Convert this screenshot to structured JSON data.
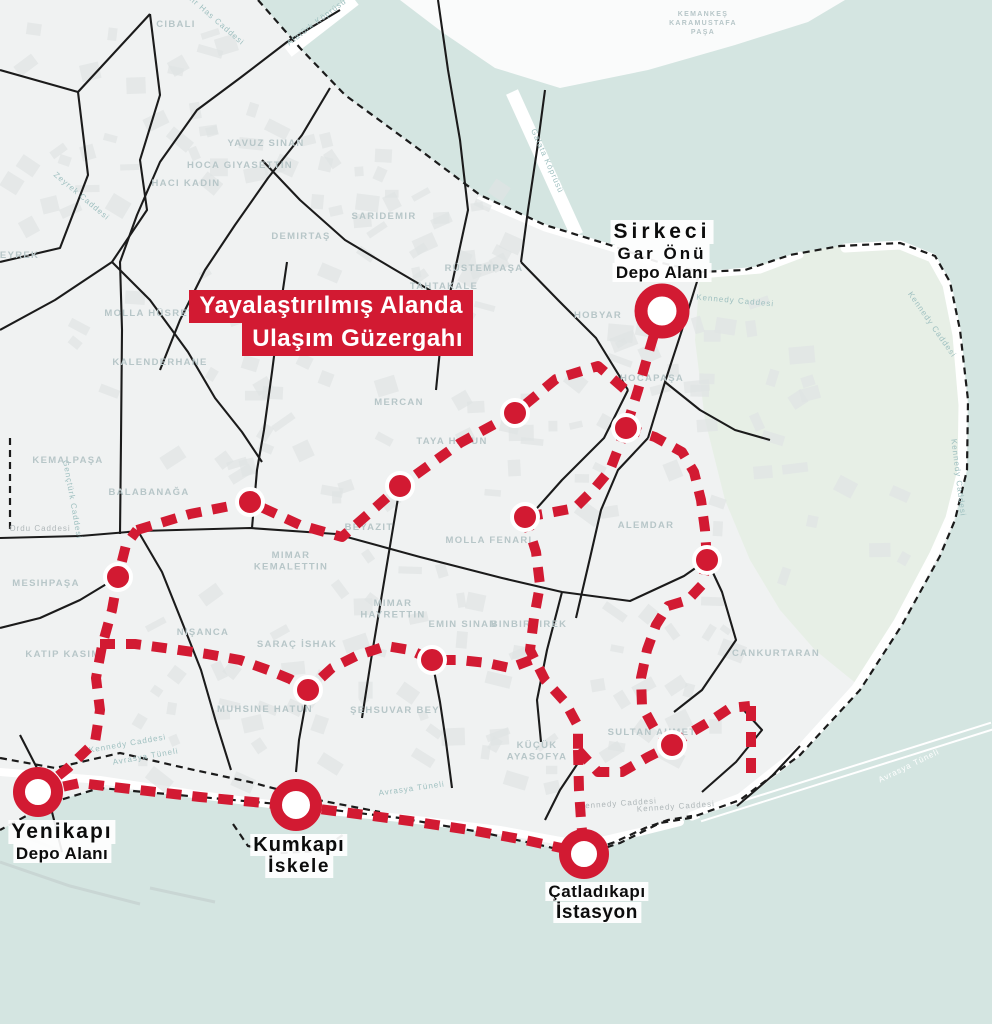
{
  "title": {
    "line1": "Yayalaştırılmış Alanda",
    "line2": "Ulaşım Güzergahı"
  },
  "colors": {
    "water": "#d4e5e1",
    "land": "#f0f2f2",
    "land_far": "#fafbfb",
    "park": "#e7efe6",
    "building": "#dfe4e4",
    "boundary": "#1b1b1b",
    "route_red": "#d21a32",
    "area_label": "#b7c6c8",
    "street_teal": "#9fc0c0",
    "street_gray": "#b0b8ba",
    "pier_gray": "#c9d6d4",
    "road_white": "#ffffff"
  },
  "terminals": [
    {
      "id": "sirkeci",
      "x": 662,
      "y": 311,
      "r": 21,
      "ring": 13,
      "label": [
        "Sirkeci",
        "Gar Önü",
        "Depo Alanı"
      ],
      "label_x": 662,
      "label_y": 220
    },
    {
      "id": "yenikapi",
      "x": 38,
      "y": 792,
      "r": 19,
      "ring": 12,
      "label": [
        "Yenikapı",
        "Depo Alanı"
      ],
      "label_x": 62,
      "label_y": 820
    },
    {
      "id": "kumkapi",
      "x": 296,
      "y": 805,
      "r": 20,
      "ring": 12,
      "label": [
        "Kumkapı",
        "İskele"
      ],
      "label_x": 299,
      "label_y": 834
    },
    {
      "id": "catladikapi",
      "x": 584,
      "y": 854,
      "r": 19,
      "ring": 12,
      "label": [
        "Çatladıkapı",
        "İstasyon"
      ],
      "label_x": 597,
      "label_y": 882
    }
  ],
  "route": {
    "stops": [
      [
        250,
        502
      ],
      [
        118,
        577
      ],
      [
        400,
        486
      ],
      [
        515,
        413
      ],
      [
        626,
        428
      ],
      [
        525,
        517
      ],
      [
        707,
        560
      ],
      [
        308,
        690
      ],
      [
        432,
        660
      ],
      [
        672,
        745
      ]
    ],
    "lines": [
      {
        "name": "coastal",
        "points": [
          [
            38,
            792
          ],
          [
            80,
            783
          ],
          [
            130,
            789
          ],
          [
            200,
            797
          ],
          [
            296,
            806
          ],
          [
            350,
            813
          ],
          [
            410,
            821
          ],
          [
            470,
            830
          ],
          [
            525,
            840
          ],
          [
            584,
            853
          ]
        ]
      },
      {
        "name": "west-vertical",
        "points": [
          [
            38,
            792
          ],
          [
            68,
            768
          ],
          [
            95,
            742
          ],
          [
            100,
            710
          ],
          [
            96,
            678
          ],
          [
            102,
            646
          ],
          [
            112,
            610
          ],
          [
            118,
            577
          ],
          [
            126,
            545
          ],
          [
            137,
            530
          ]
        ]
      },
      {
        "name": "central",
        "points": [
          [
            137,
            530
          ],
          [
            190,
            514
          ],
          [
            250,
            502
          ],
          [
            300,
            525
          ],
          [
            342,
            537
          ],
          [
            400,
            486
          ],
          [
            460,
            443
          ],
          [
            515,
            413
          ],
          [
            556,
            379
          ],
          [
            598,
            366
          ],
          [
            628,
            392
          ]
        ]
      },
      {
        "name": "sirkeci-link",
        "points": [
          [
            661,
            311
          ],
          [
            650,
            348
          ],
          [
            638,
            390
          ],
          [
            626,
            428
          ]
        ]
      },
      {
        "name": "hocapasa-alemdar",
        "points": [
          [
            626,
            428
          ],
          [
            655,
            437
          ],
          [
            682,
            452
          ],
          [
            694,
            472
          ],
          [
            701,
            500
          ],
          [
            705,
            530
          ],
          [
            707,
            560
          ]
        ]
      },
      {
        "name": "hocapasa-mollafenari",
        "points": [
          [
            626,
            428
          ],
          [
            610,
            470
          ],
          [
            595,
            488
          ],
          [
            575,
            508
          ],
          [
            549,
            513
          ],
          [
            525,
            517
          ]
        ]
      },
      {
        "name": "mollafenari-kucukayasofya",
        "points": [
          [
            525,
            517
          ],
          [
            536,
            552
          ],
          [
            540,
            585
          ],
          [
            534,
            618
          ],
          [
            530,
            650
          ],
          [
            545,
            680
          ],
          [
            565,
            702
          ],
          [
            578,
            726
          ],
          [
            578,
            750
          ]
        ]
      },
      {
        "name": "kucukayasofya-sultan",
        "points": [
          [
            578,
            750
          ],
          [
            598,
            772
          ],
          [
            622,
            772
          ],
          [
            648,
            757
          ],
          [
            672,
            745
          ]
        ]
      },
      {
        "name": "kucukayasofya-catladikapi",
        "points": [
          [
            578,
            750
          ],
          [
            579,
            790
          ],
          [
            581,
            820
          ],
          [
            584,
            853
          ]
        ]
      },
      {
        "name": "alemdar-sultan",
        "points": [
          [
            707,
            560
          ],
          [
            702,
            585
          ],
          [
            688,
            600
          ],
          [
            668,
            606
          ],
          [
            656,
            625
          ],
          [
            647,
            650
          ],
          [
            641,
            678
          ],
          [
            642,
            706
          ],
          [
            654,
            728
          ],
          [
            672,
            745
          ]
        ]
      },
      {
        "name": "nisanca",
        "points": [
          [
            100,
            644
          ],
          [
            135,
            644
          ],
          [
            172,
            649
          ],
          [
            207,
            654
          ],
          [
            240,
            660
          ],
          [
            268,
            670
          ],
          [
            290,
            679
          ],
          [
            308,
            690
          ],
          [
            332,
            668
          ],
          [
            356,
            656
          ],
          [
            386,
            646
          ],
          [
            410,
            650
          ],
          [
            432,
            660
          ],
          [
            460,
            660
          ],
          [
            487,
            663
          ],
          [
            510,
            668
          ],
          [
            531,
            660
          ]
        ]
      },
      {
        "name": "east-branch",
        "points": [
          [
            672,
            745
          ],
          [
            690,
            733
          ],
          [
            712,
            720
          ],
          [
            730,
            708
          ],
          [
            750,
            706
          ]
        ]
      },
      {
        "name": "east-branch-vertical",
        "points": [
          [
            751,
            706
          ],
          [
            751,
            740
          ],
          [
            751,
            773
          ]
        ]
      }
    ]
  },
  "area_labels": [
    {
      "text": "CIBALI",
      "x": 176,
      "y": 27
    },
    {
      "text": "KEMANKEŞ\nKARAMUSTAFA\nPAŞA",
      "x": 703,
      "y": 16,
      "fs": 7
    },
    {
      "text": "YAVUZ SINAN",
      "x": 266,
      "y": 146
    },
    {
      "text": "HOCA GIYASETTIN",
      "x": 240,
      "y": 168
    },
    {
      "text": "HACI KADIN",
      "x": 186,
      "y": 186
    },
    {
      "text": "SARIDEMIR",
      "x": 384,
      "y": 219
    },
    {
      "text": "DEMIRTAŞ",
      "x": 301,
      "y": 239
    },
    {
      "text": "RÜSTEMPAŞA",
      "x": 484,
      "y": 271
    },
    {
      "text": "TAHTAKALE",
      "x": 444,
      "y": 289
    },
    {
      "text": "ZEYREK",
      "x": 16,
      "y": 258
    },
    {
      "text": "MOLLA HÜSREV",
      "x": 150,
      "y": 316
    },
    {
      "text": "HOBYAR",
      "x": 598,
      "y": 318
    },
    {
      "text": "KALENDERHANE",
      "x": 160,
      "y": 365
    },
    {
      "text": "MERCAN",
      "x": 399,
      "y": 405
    },
    {
      "text": "TAYA HATUN",
      "x": 452,
      "y": 444
    },
    {
      "text": "HOCAPAŞA",
      "x": 652,
      "y": 381
    },
    {
      "text": "KEMALPAŞA",
      "x": 68,
      "y": 463
    },
    {
      "text": "BALABANAĞA",
      "x": 149,
      "y": 495
    },
    {
      "text": "BEYAZIT",
      "x": 369,
      "y": 530
    },
    {
      "text": "MOLLA FENARI",
      "x": 489,
      "y": 543
    },
    {
      "text": "ALEMDAR",
      "x": 646,
      "y": 528
    },
    {
      "text": "MIMAR\nKEMALETTIN",
      "x": 291,
      "y": 558
    },
    {
      "text": "MESIHPAŞA",
      "x": 46,
      "y": 586
    },
    {
      "text": "MIMAR\nHAYRETTIN",
      "x": 393,
      "y": 606
    },
    {
      "text": "EMIN SINAN",
      "x": 463,
      "y": 627
    },
    {
      "text": "BINBIRDIREK",
      "x": 529,
      "y": 627
    },
    {
      "text": "NIŞANCA",
      "x": 203,
      "y": 635
    },
    {
      "text": "SARAÇ İSHAK",
      "x": 297,
      "y": 647
    },
    {
      "text": "KATIP KASIM",
      "x": 63,
      "y": 657
    },
    {
      "text": "MUHSINE HATUN",
      "x": 265,
      "y": 712
    },
    {
      "text": "ŞEHSUVAR BEY",
      "x": 395,
      "y": 713
    },
    {
      "text": "KÜÇÜK\nAYASOFYA",
      "x": 537,
      "y": 748
    },
    {
      "text": "SULTAN AHMET",
      "x": 652,
      "y": 735
    },
    {
      "text": "CANKURTARAN",
      "x": 776,
      "y": 656
    }
  ],
  "street_labels": [
    {
      "text": "Kadir Has Caddesi",
      "x": 210,
      "y": 18,
      "rot": 41,
      "tone": "teal"
    },
    {
      "text": "Atatürk Köprüsü",
      "x": 318,
      "y": 24,
      "rot": -37,
      "tone": "teal"
    },
    {
      "text": "Galata Köprüsü",
      "x": 545,
      "y": 162,
      "rot": 66,
      "tone": "teal"
    },
    {
      "text": "Zeyrek Caddesi",
      "x": 80,
      "y": 198,
      "rot": 40,
      "tone": "teal"
    },
    {
      "text": "Kennedy Caddesi",
      "x": 735,
      "y": 303,
      "rot": 5,
      "tone": "teal"
    },
    {
      "text": "Kennedy Caddesi",
      "x": 930,
      "y": 326,
      "rot": 55,
      "tone": "teal"
    },
    {
      "text": "Kennedy Caddesi",
      "x": 956,
      "y": 478,
      "rot": 83,
      "tone": "teal"
    },
    {
      "text": "Gençtürk Caddesi",
      "x": 70,
      "y": 500,
      "rot": 80,
      "tone": "teal"
    },
    {
      "text": "Ordu Caddesi",
      "x": 40,
      "y": 531,
      "rot": 0,
      "tone": "gray"
    },
    {
      "text": "Kennedy Caddesi",
      "x": 128,
      "y": 746,
      "rot": -10,
      "tone": "teal"
    },
    {
      "text": "Avrasya Tüneli",
      "x": 146,
      "y": 759,
      "rot": -10,
      "tone": "teal"
    },
    {
      "text": "Avrasya Tüneli",
      "x": 412,
      "y": 791,
      "rot": -8,
      "tone": "teal"
    },
    {
      "text": "Kennedy Caddesi",
      "x": 618,
      "y": 806,
      "rot": -4,
      "tone": "gray"
    },
    {
      "text": "Kennedy Caddesi",
      "x": 676,
      "y": 809,
      "rot": -4,
      "tone": "gray"
    },
    {
      "text": "Avrasya Tüneli",
      "x": 910,
      "y": 768,
      "rot": -26,
      "tone": "white"
    }
  ]
}
